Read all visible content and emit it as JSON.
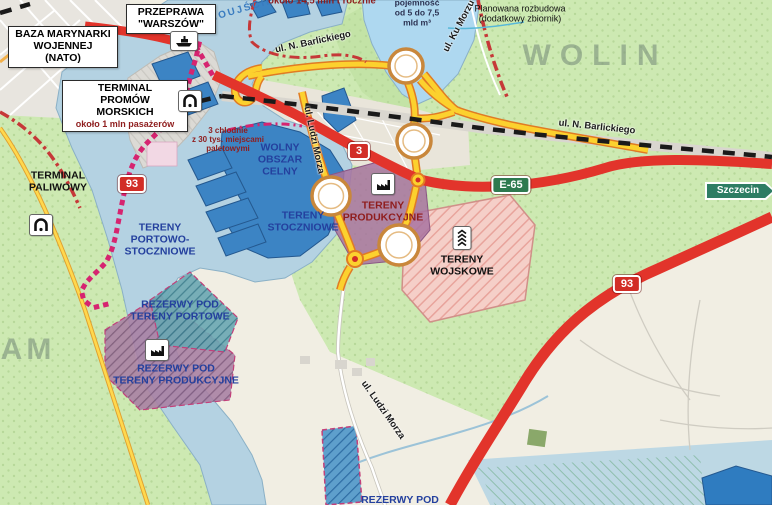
{
  "place_labels": {
    "wolin": "WOLIN",
    "uznam": "AM",
    "channel": "ŚWINOUJŚCIE"
  },
  "info_boxes": {
    "naval_base": {
      "l1": "BAZA MARYNARKI",
      "l2": "WOJENNEJ",
      "l3": "(NATO)"
    },
    "crossing": {
      "l1": "PRZEPRAWA",
      "l2": "\"WARSZÓW\""
    },
    "ferry_terminal": {
      "l1": "TERMINAL",
      "l2": "PROMÓW",
      "l3": "MORSKICH",
      "sub": "około 1 mln pasażerów"
    }
  },
  "areas": {
    "fuel": {
      "l1": "TERMINAL",
      "l2": "PALIWOWY"
    },
    "port_shipyard": {
      "l1": "TERENY",
      "l2": "PORTOWO-",
      "l3": "STOCZNIOWE"
    },
    "port_reserve": {
      "l1": "REZERWY POD",
      "l2": "TERENY PORTOWE"
    },
    "prod_reserve": {
      "l1": "REZERWY POD",
      "l2": "TERENY PRODUKCYJNE"
    },
    "customs": {
      "l1": "WOLNY",
      "l2": "OBSZAR",
      "l3": "CELNY"
    },
    "shipyard": {
      "l1": "TERENY",
      "l2": "STOCZNIOWE"
    },
    "production": {
      "l1": "TERENY",
      "l2": "PRODUKCYJNE"
    },
    "military": {
      "l1": "TERENY",
      "l2": "WOJSKOWE"
    },
    "reserve_bottom": {
      "l1": "REZERWY POD"
    }
  },
  "notes": {
    "tonnage": "około 14,5 mln t rocznie",
    "capacity": {
      "l1": "pojemność",
      "l2": "od 5 do 7,5",
      "l3": "mld m³"
    },
    "expansion": {
      "l1": "Planowana rozbudowa",
      "l2": "(dodatkowy zbiornik)"
    },
    "cold": {
      "l1": "3 chłodnie",
      "l2": "z 30 tys. miejscami",
      "l3": "paletowymi"
    }
  },
  "streets": {
    "barlickiego_w": "ul. N. Barlickiego",
    "barlickiego_e": "ul. N. Barlickiego",
    "ku_morzu": "ul. Ku Morzu",
    "ludzi_morza_n": "ul. Ludzi Morza",
    "ludzi_morza_s": "ul. Ludzi Morza"
  },
  "shields": {
    "route3": "3",
    "route93_w": "93",
    "route93_e": "93",
    "e65": "E-65"
  },
  "sign": {
    "szczecin": "Szczecin"
  },
  "colors": {
    "road_red": "#e2342b",
    "road_yellow": "#fcd12e",
    "yellow_casing": "#e07b24",
    "magenta_dots": "#d62470",
    "crimson_dashdot": "#c63838",
    "shield_red": "#d22d26",
    "shield_green": "#2d7a4f",
    "sign_green": "#2e7d64",
    "label_navy": "#24409e",
    "label_darkred": "#8f1d1d",
    "water": "#b4d2e2",
    "lagoon": "#aed8f0",
    "pier_blue": "#3c84c4",
    "green_land": "#cde9b2",
    "military_pink": "#f5cfc8",
    "production_mauve": "#a873a0"
  }
}
